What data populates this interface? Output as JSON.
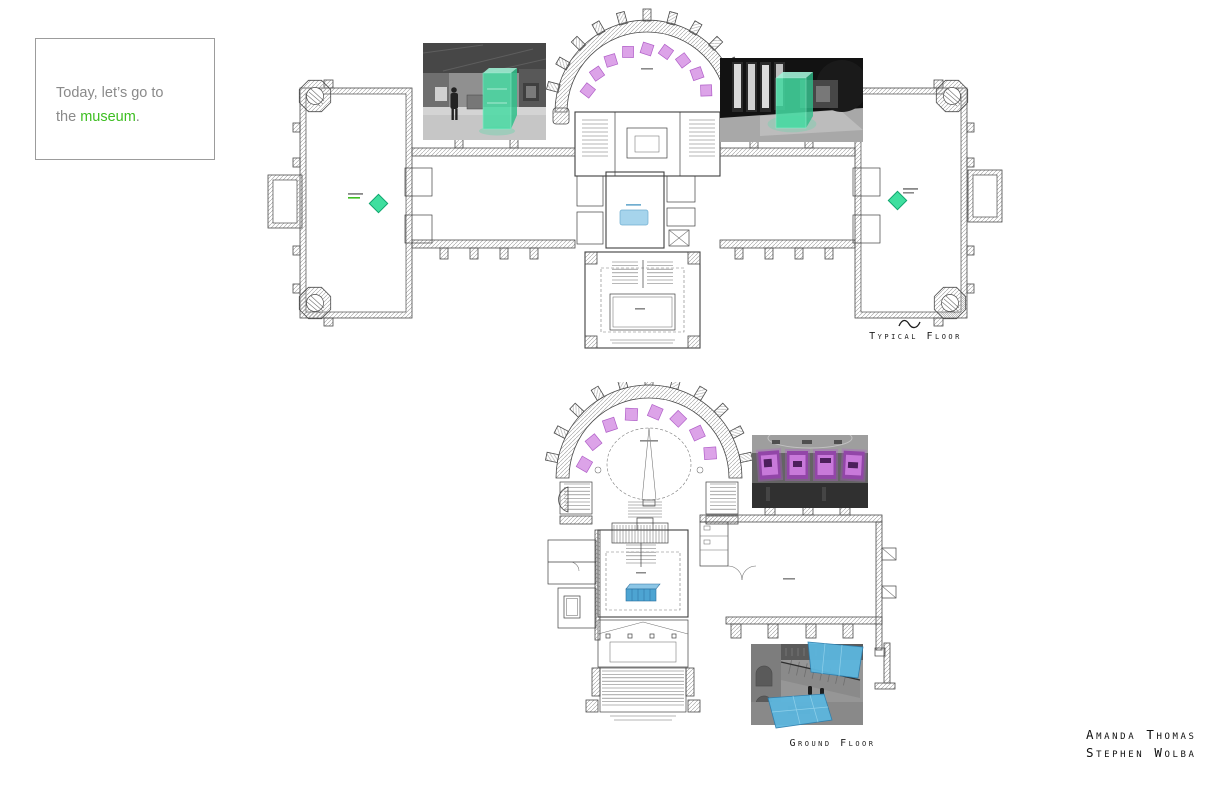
{
  "quote": {
    "line1": "Today, let’s go to",
    "line2_pre": "the ",
    "line2_highlight": "museum",
    "line2_post": "."
  },
  "plans": {
    "typical": {
      "label": "Typical Floor"
    },
    "ground": {
      "label": "Ground Floor"
    }
  },
  "credits": {
    "authors": [
      "Amanda Thomas",
      "Stephen Wolba"
    ]
  },
  "annotations": {
    "rotunda_artworks": {
      "typical": 9,
      "ground": 8
    },
    "wing_sculpture_markers": 2,
    "highlighted_display_cases": 2,
    "highlighted_blue_planes": 2
  },
  "colors": {
    "highlight-green": "#3dbe21",
    "marker-green-fill": "#3fdf9f",
    "marker-green-stroke": "#10a56e",
    "overlay-green": "#45dca3",
    "artwork-purple-fill": "#dca3e8",
    "artwork-purple-stroke": "#b05fc8",
    "gallery-purple": "#9246a8",
    "plan-blue-fill": "#a6d4ec",
    "plan-blue-stroke": "#70aed0",
    "stage-blue": "#4da4d2",
    "plane-blue": "#5cb6de"
  }
}
